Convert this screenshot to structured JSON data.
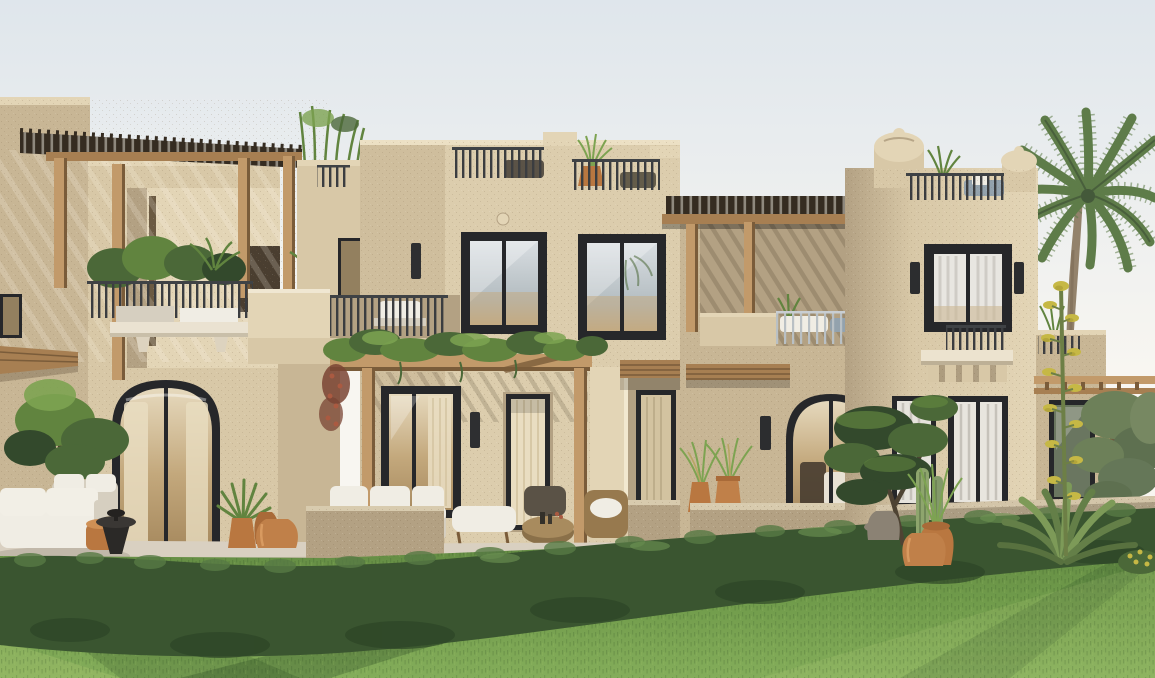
{
  "meta": {
    "description": "Photorealistic 3D exterior rendering of a row of two-storey sandstone villas in a desert-Mediterranean style, viewed from a green lawn under late-afternoon sunlight with a pale sky.",
    "render_type": "architectural exterior visualization",
    "visible_text": "none"
  },
  "palette": {
    "sky-top": "#dfe6ec",
    "sky-low": "#f8f6f1",
    "wall-bright": "#e3d5b6",
    "wall-sun": "#d8c8a7",
    "wall-mid": "#c8b695",
    "wall-shade": "#b3a183",
    "wall-dark": "#9c8a6c",
    "wood-light": "#c29a6a",
    "wood": "#a77f52",
    "wood-dark": "#7a5c3a",
    "slat": "#352c21",
    "frame": "#26272a",
    "glass-dim": "#93805f",
    "curtain": "#e9ddc1",
    "curtain-dim": "#d3c3a0",
    "metal": "#3f4245",
    "metal-light": "#b9c0c4",
    "white": "#f0ede4",
    "white-dim": "#d6cfc0",
    "terracotta": "#b97740",
    "terracotta-dark": "#a96a38",
    "pot-light": "#c08049",
    "green-dark": "#33492c",
    "green": "#4b6838",
    "green-mid": "#61843f",
    "green-light": "#7da351",
    "grass": "#6f9a4a",
    "grass-light": "#84ad5a",
    "hedge": "#3a5530",
    "hedge-light": "#577a44",
    "paving": "#d9d0c1",
    "paving-shade": "#c0b6a4",
    "trunk": "#93826b",
    "palm": "#5e7c49",
    "palm-dark": "#44593a",
    "olive": "#6d8059",
    "blue-cushion": "#93a2ad",
    "flower-yellow": "#c6b845",
    "flower-red": "#aa5a41"
  },
  "scene": {
    "sky": "pale hazy white-blue sky",
    "buildings": [
      {
        "name": "left-villa",
        "features": [
          "rooftop wooden pergola with ragged slat roof",
          "balcony with dark railing, shrubs and white planter ledge on stone brackets",
          "arched black-framed glass door with cream curtains",
          "wooden awning",
          "courtyard walls behind"
        ]
      },
      {
        "name": "middle-villa",
        "features": [
          "roof parapet with two dark railings, wicker furniture and potted fountain grass",
          "two black-framed upper windows",
          "round wall medallion",
          "dark wall sconces",
          "vine-covered wooden pergola over ground terrace",
          "glass doors with curtains",
          "second-floor terrace with railing and white sofa",
          "roof-terrace tower with bamboo plants"
        ]
      },
      {
        "name": "canopy-villa",
        "features": [
          "large wooden slatted canopy over upper terrace",
          "balcony with light railing and white & blue cushions",
          "wooden awning",
          "arched glass door with lounge chairs",
          "wall sconce"
        ]
      },
      {
        "name": "right-villa",
        "features": [
          "parapet piers with rounded dome finials",
          "roof terrace railing with plants and blue cushions",
          "large black-framed window with white sheer curtains",
          "two cylindrical sconces",
          "juliet balcony on corbel ledge",
          "two ground-floor windows with curtains",
          "side wing with far pergola and tree-reflecting window"
        ]
      }
    ],
    "vegetation": [
      "tall palm tree",
      "olive trees",
      "garden tree beside left patio",
      "layered topiary tree",
      "columnar cactus",
      "agave with tall yellow-flowered bloom stalk",
      "fountain-grass in terracotta pots",
      "aloe in terracotta pots",
      "vines with red bougainvillea accents"
    ],
    "foreground": [
      "white outdoor lounge sofas",
      "black pedestal side tables",
      "terracotta stool and urns",
      "rattan coffee table and armchair",
      "light stone patio",
      "long speckled garden wall",
      "wild hedge band",
      "sunlit lawn with diagonal light and shadow streaks"
    ]
  }
}
